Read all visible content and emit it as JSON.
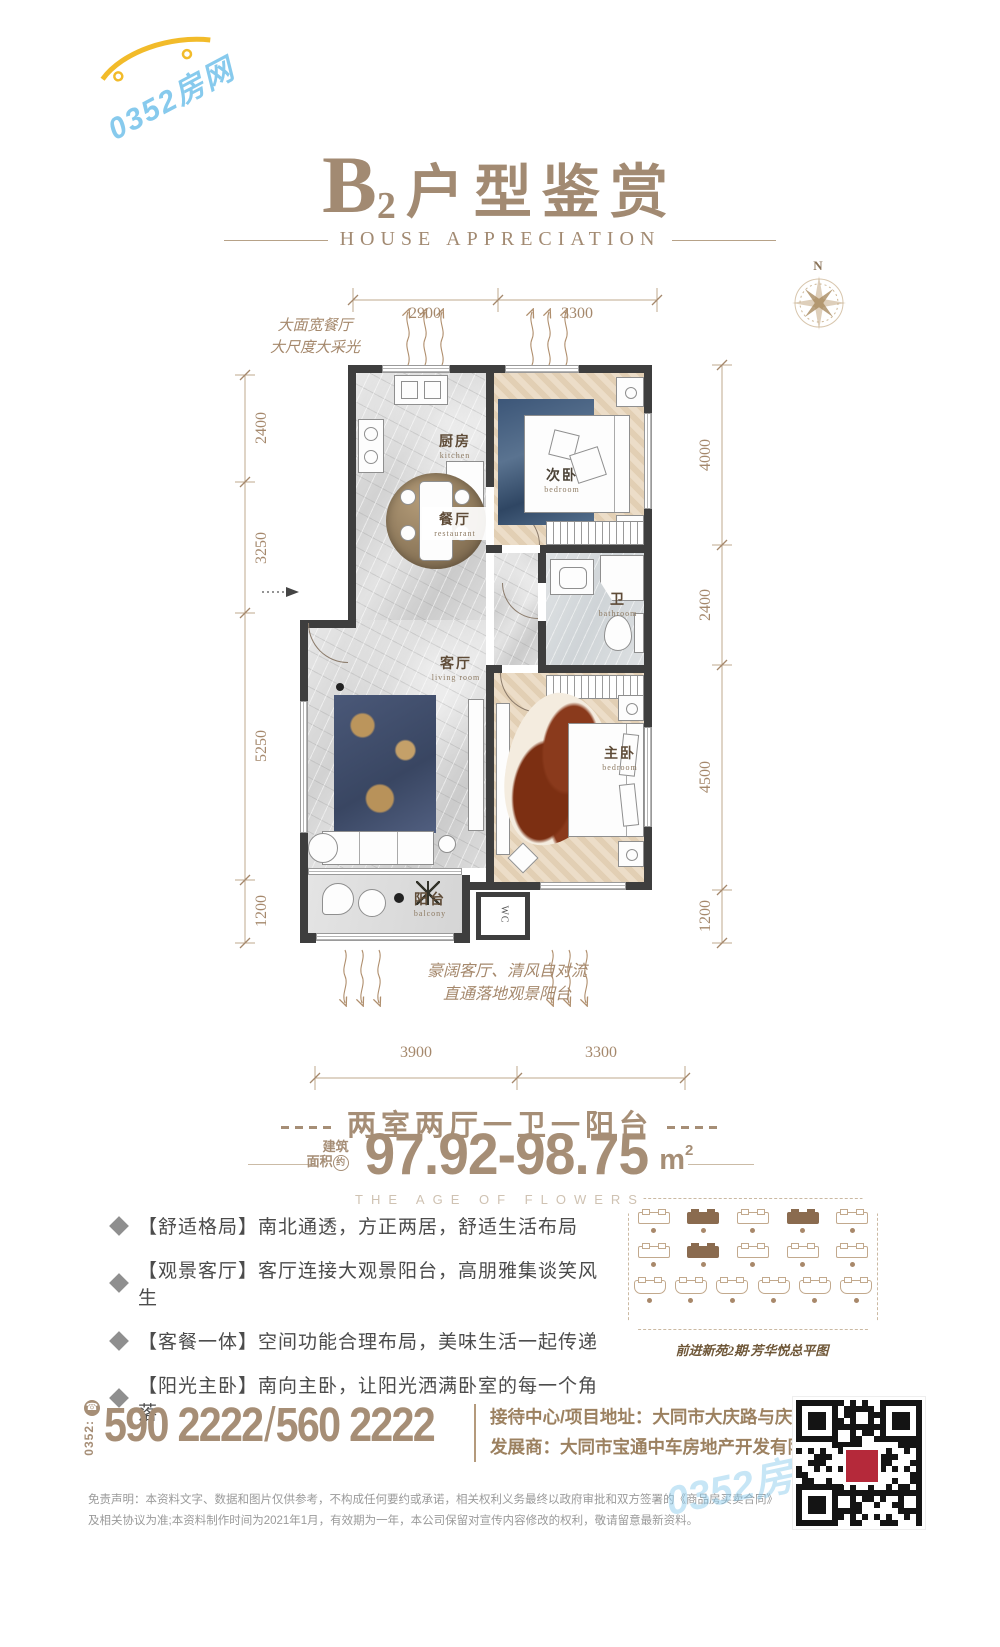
{
  "theme": {
    "accent": "#a68e76",
    "wall": "#3e3e3e",
    "dim_text": "#a5886c",
    "feature_text": "#4c4c4c",
    "highlight_brown": "#8a6b4f",
    "qr_red": "#b5293a",
    "watermark_blue": "#7dc6ec"
  },
  "watermark": {
    "text": "0352房网"
  },
  "header": {
    "title_letter": "B",
    "title_index": "2",
    "title_text": "户型鉴赏",
    "subtitle": "HOUSE APPRECIATION"
  },
  "compass": {
    "north_label": "N"
  },
  "floorplan": {
    "annotation_top": [
      "大面宽餐厅",
      "大尺度大采光"
    ],
    "annotation_bottom": [
      "豪阔客厅、清风自对流",
      "直通落地观景阳台"
    ],
    "dims": {
      "top": [
        "2900",
        "3300"
      ],
      "left": [
        "2400",
        "3250",
        "5250",
        "1200"
      ],
      "right": [
        "4000",
        "2400",
        "4500",
        "1200"
      ],
      "bottom": [
        "3900",
        "3300"
      ]
    },
    "rooms": {
      "kitchen": {
        "name": "厨房",
        "en": "kitchen"
      },
      "dining": {
        "name": "餐厅",
        "en": "restaurant"
      },
      "bedroom2": {
        "name": "次卧",
        "en": "bedroom"
      },
      "bath": {
        "name": "卫",
        "en": "bathroom"
      },
      "living": {
        "name": "客厅",
        "en": "living room"
      },
      "master": {
        "name": "主卧",
        "en": "bedroom"
      },
      "balcony": {
        "name": "阳台",
        "en": "balcony"
      }
    },
    "wc_label": "WC"
  },
  "summary": {
    "layout_line": "两室两厅一卫一阳台",
    "area_label_line1": "建筑",
    "area_label_line2": "面积",
    "area_label_circled": "约",
    "area_value": "97.92-98.75",
    "area_unit": "m",
    "area_unit_sup": "2",
    "tagline": "THE AGE OF FLOWERS"
  },
  "features": [
    "【舒适格局】南北通透，方正两居，舒适生活布局",
    "【观景客厅】客厅连接大观景阳台，高朋雅集谈笑风生",
    "【客餐一体】空间功能合理布局，美味生活一起传递",
    "【阳光主卧】南向主卧，让阳光洒满卧室的每一个角落"
  ],
  "siteplan": {
    "caption": "前进新苑2期·芳华悦总平图",
    "rows": [
      {
        "count": 5,
        "style": "bar",
        "highlights": [
          1,
          3
        ]
      },
      {
        "count": 5,
        "style": "bar",
        "highlights": [
          1
        ]
      },
      {
        "count": 6,
        "style": "u",
        "highlights": []
      }
    ]
  },
  "contact": {
    "phone_icon": "☎",
    "area_code": "0352:",
    "phone1": "590 2222",
    "separator": "/",
    "phone2": "560 2222",
    "address_label": "接待中心/项目地址：",
    "address_value": "大同市大庆路与庆新路交汇处",
    "developer_label": "发展商：",
    "developer_value": "大同市宝通中车房地产开发有限公司"
  },
  "disclaimer": [
    "免责声明：本资料文字、数据和图片仅供参考，不构成任何要约或承诺，相关权利义务最终以政府审批和双方签署的《商品房买卖合同》及相关协议为准;本资料制作时间为",
    "2021年1月，有效期为一年，本公司保留对宣传内容修改的权利，敬请留意最新资料。"
  ]
}
